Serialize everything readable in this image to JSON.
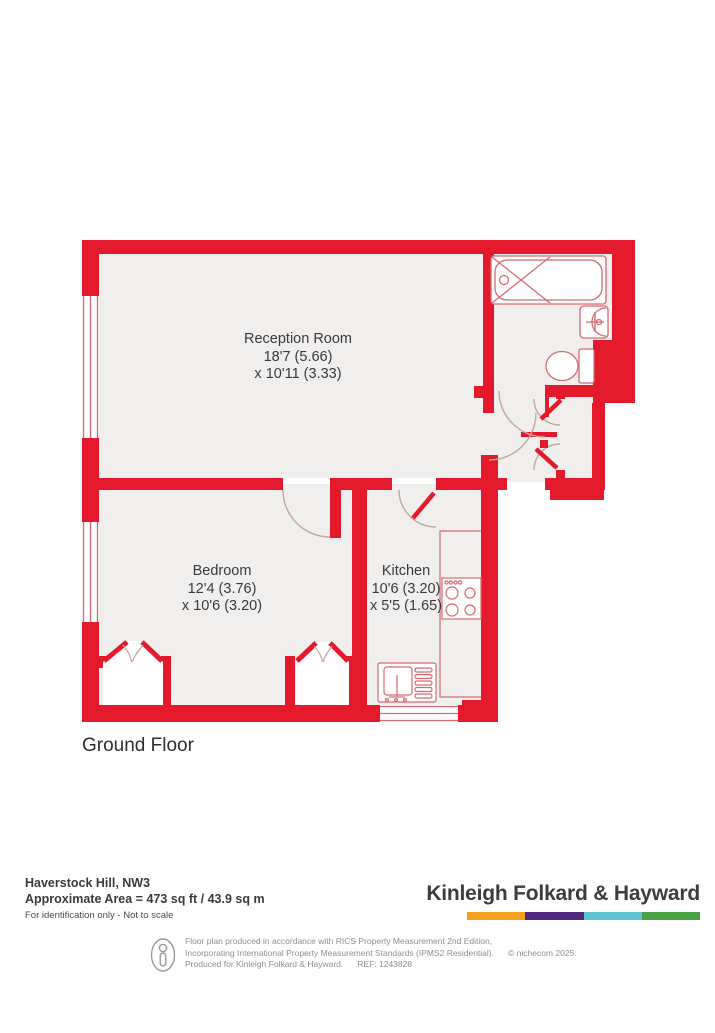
{
  "floorplan": {
    "floor_label": "Ground Floor",
    "rooms": [
      {
        "name": "Reception Room",
        "line1": "18'7 (5.66)",
        "line2": "x 10'11 (3.33)"
      },
      {
        "name": "Bedroom",
        "line1": "12'4 (3.76)",
        "line2": "x 10'6 (3.20)"
      },
      {
        "name": "Kitchen",
        "line1": "10'6 (3.20)",
        "line2": "x 5'5 (1.65)"
      }
    ],
    "colors": {
      "wall": "#E4192B",
      "interior": "#F1EFED",
      "fixture_line": "#D66A70",
      "door_arc": "#C7A6A0"
    }
  },
  "footer": {
    "address": "Haverstock Hill, NW3",
    "area": "Approximate Area = 473 sq ft / 43.9 sq m",
    "note": "For identification only - Not to scale",
    "brand": "Kinleigh Folkard & Hayward",
    "brand_colors": [
      "#F5A01E",
      "#4F2A7E",
      "#62C4CE",
      "#4BA145"
    ]
  },
  "disclaimer": {
    "line1": "Floor plan produced in accordance with RICS Property Measurement 2nd Edition,",
    "line2": "Incorporating International Property Measurement Standards (IPMS2 Residential).",
    "copyright": "© nichecom 2025.",
    "line3": "Produced for Kinleigh Folkard & Hayward.",
    "ref": "REF: 1243828"
  }
}
